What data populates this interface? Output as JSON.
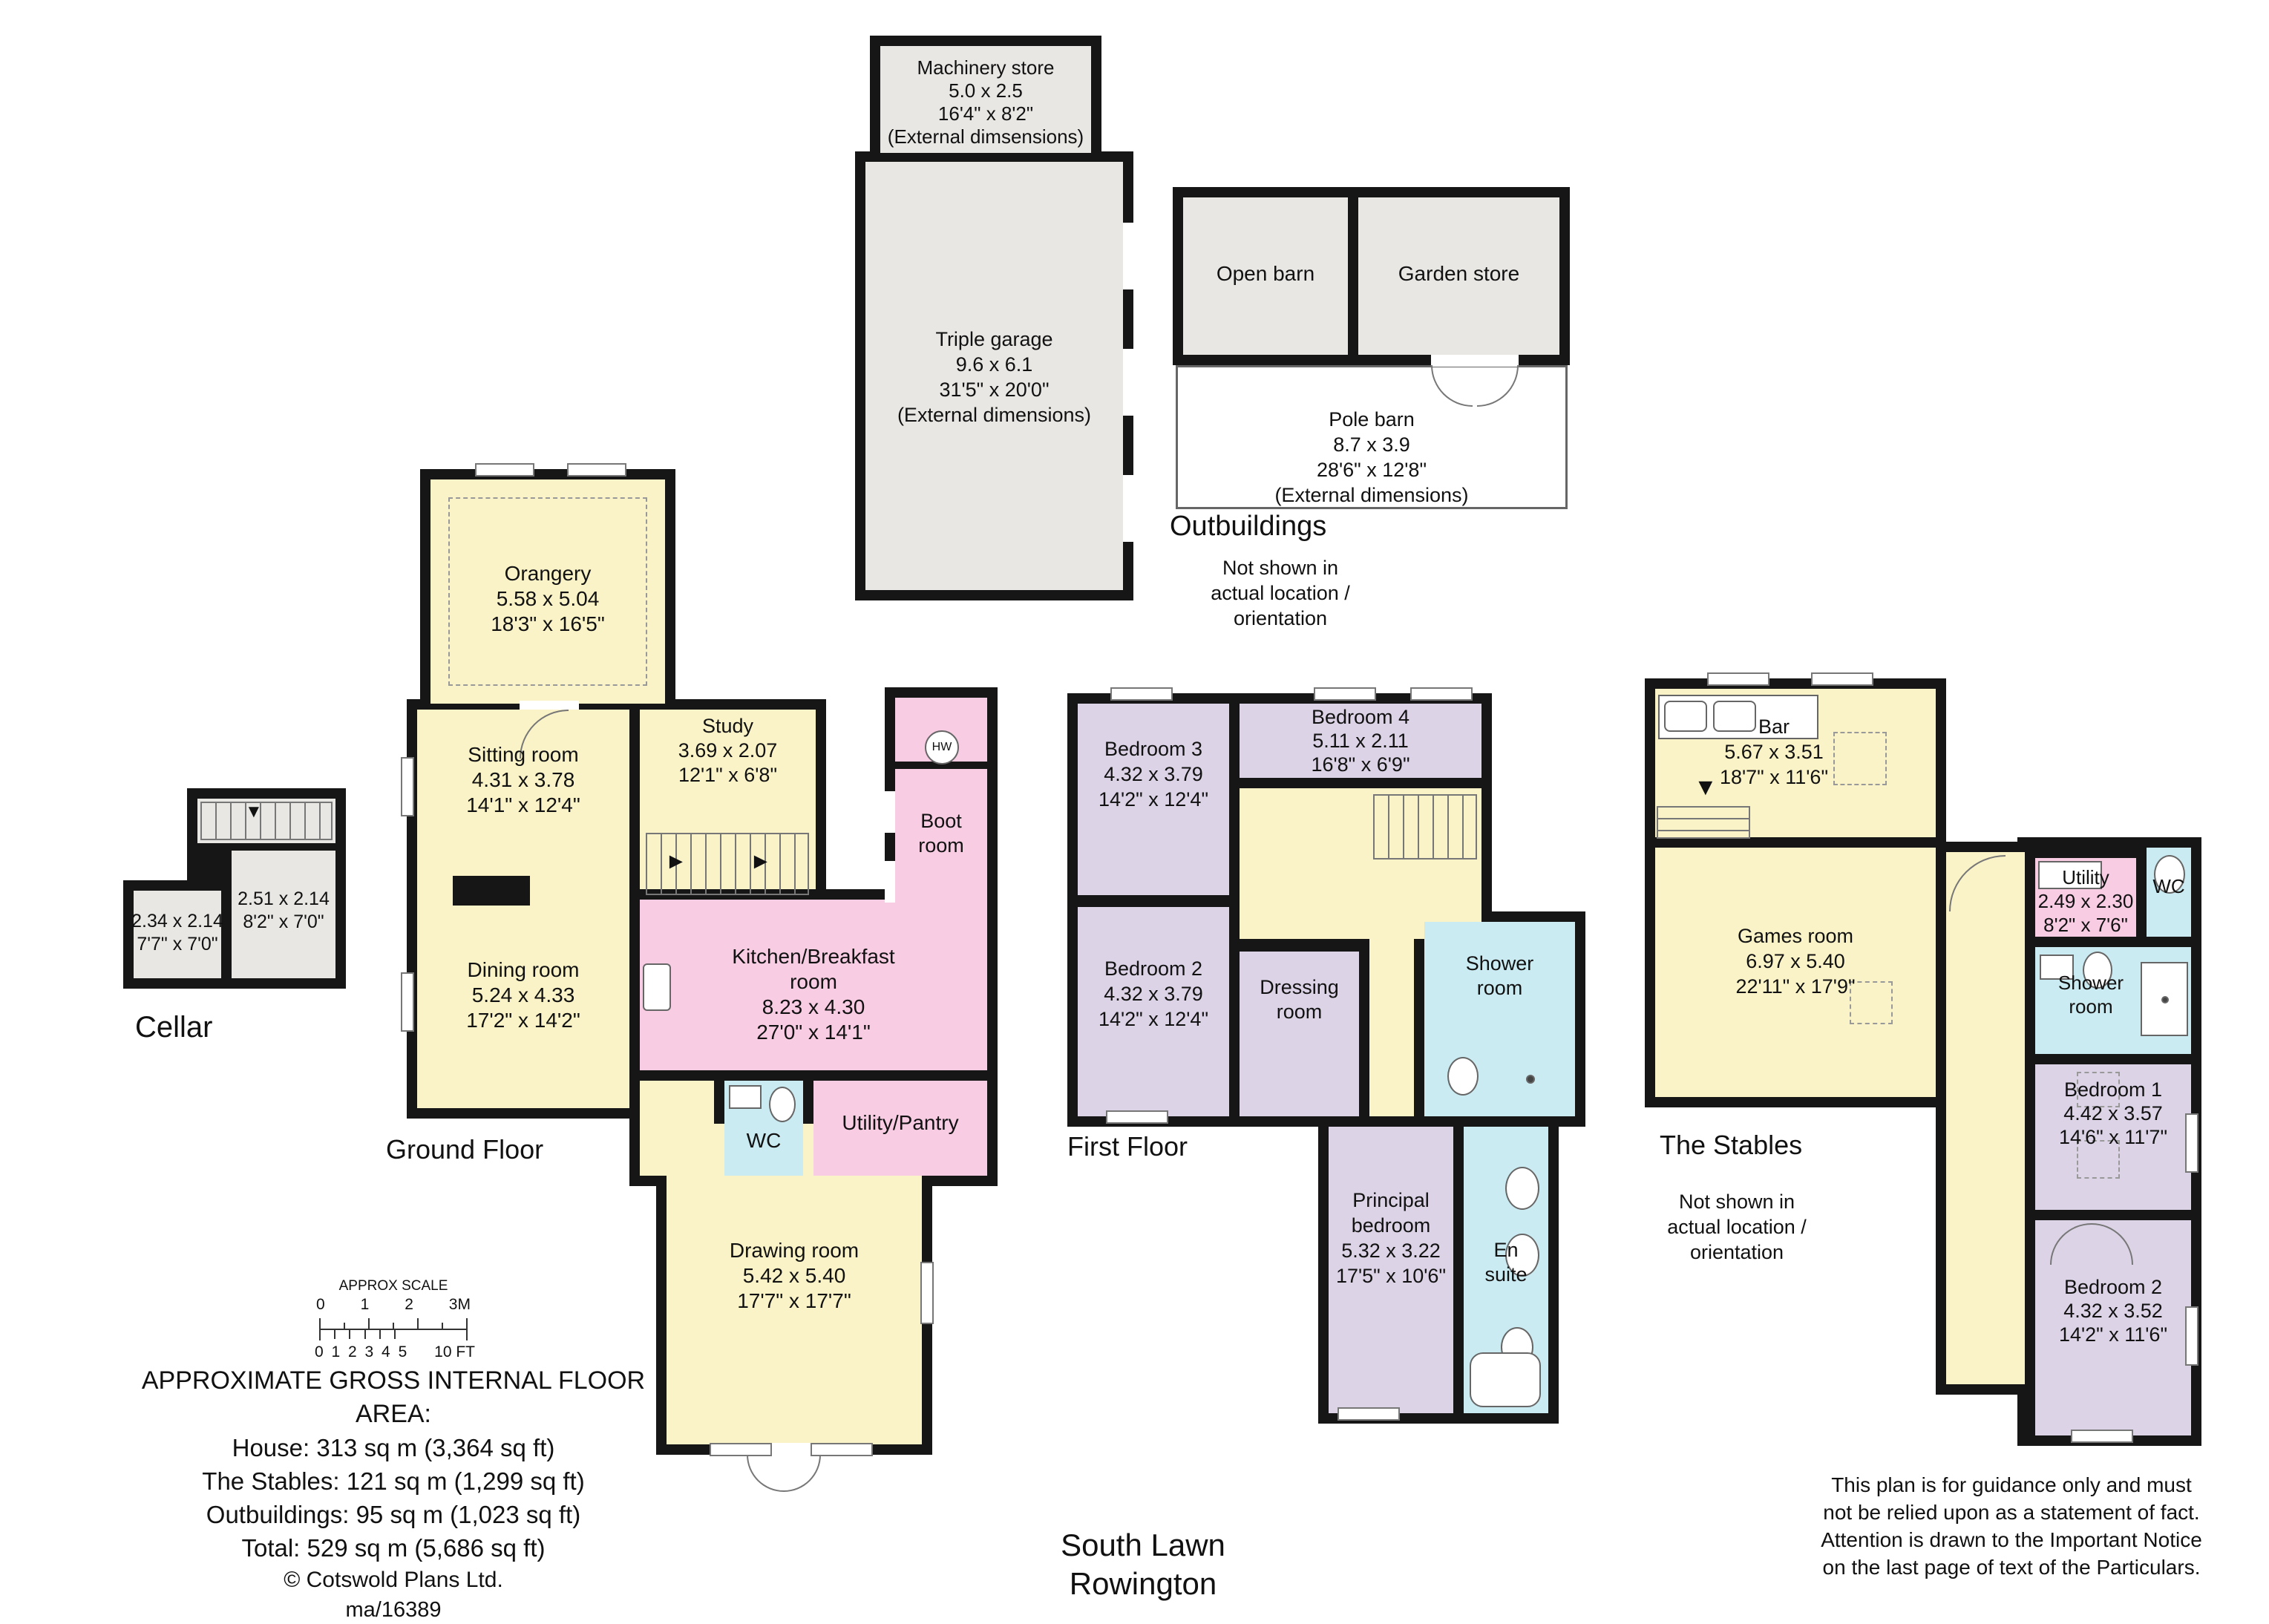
{
  "colors": {
    "wall": "#161616",
    "yellow": "#faf3c8",
    "pink": "#f8cce3",
    "purple": "#dcd3e6",
    "cyan": "#cbebf2",
    "gray": "#e8e7e4"
  },
  "outbuildings": {
    "heading": "Outbuildings",
    "note": "Not shown in\nactual location /\norientation",
    "machinery_store": {
      "name": "Machinery store",
      "m": "5.0 x 2.5",
      "ft": "16'4\" x 8'2\"",
      "note": "(External dimsensions)"
    },
    "triple_garage": {
      "name": "Triple garage",
      "m": "9.6 x 6.1",
      "ft": "31'5\" x 20'0\"",
      "note": "(External dimensions)"
    },
    "open_barn": {
      "name": "Open barn"
    },
    "garden_store": {
      "name": "Garden store"
    },
    "pole_barn": {
      "name": "Pole barn",
      "m": "8.7 x 3.9",
      "ft": "28'6\" x 12'8\"",
      "note": "(External dimensions)"
    }
  },
  "ground_floor": {
    "heading": "Ground Floor",
    "cellar_heading": "Cellar",
    "orangery": {
      "name": "Orangery",
      "m": "5.58 x 5.04",
      "ft": "18'3\" x 16'5\""
    },
    "sitting_room": {
      "name": "Sitting room",
      "m": "4.31 x 3.78",
      "ft": "14'1\" x 12'4\""
    },
    "study": {
      "name": "Study",
      "m": "3.69 x 2.07",
      "ft": "12'1\" x 6'8\""
    },
    "dining_room": {
      "name": "Dining room",
      "m": "5.24 x 4.33",
      "ft": "17'2\" x 14'2\""
    },
    "kitchen": {
      "name": "Kitchen/Breakfast\nroom",
      "m": "8.23 x 4.30",
      "ft": "27'0\" x 14'1\""
    },
    "boot_room": {
      "name": "Boot\nroom"
    },
    "wc": {
      "name": "WC"
    },
    "utility_pantry": {
      "name": "Utility/Pantry"
    },
    "drawing_room": {
      "name": "Drawing room",
      "m": "5.42 x 5.40",
      "ft": "17'7\" x 17'7\""
    },
    "hw": "HW",
    "cellar_left": {
      "m": "2.34 x 2.14",
      "ft": "7'7\" x 7'0\""
    },
    "cellar_right": {
      "m": "2.51 x 2.14",
      "ft": "8'2\" x 7'0\""
    }
  },
  "first_floor": {
    "heading": "First Floor",
    "bedroom_3": {
      "name": "Bedroom 3",
      "m": "4.32 x 3.79",
      "ft": "14'2\" x 12'4\""
    },
    "bedroom_4": {
      "name": "Bedroom 4",
      "m": "5.11 x 2.11",
      "ft": "16'8\" x 6'9\""
    },
    "bedroom_2": {
      "name": "Bedroom 2",
      "m": "4.32 x 3.79",
      "ft": "14'2\" x 12'4\""
    },
    "dressing": {
      "name": "Dressing\nroom"
    },
    "shower": {
      "name": "Shower\nroom"
    },
    "principal": {
      "name": "Principal\nbedroom",
      "m": "5.32 x 3.22",
      "ft": "17'5\" x 10'6\""
    },
    "en_suite": {
      "name": "En\nsuite"
    }
  },
  "stables": {
    "heading": "The Stables",
    "note": "Not shown in\nactual location /\norientation",
    "bar": {
      "name": "Bar",
      "m": "5.67 x 3.51",
      "ft": "18'7\" x 11'6\""
    },
    "games_room": {
      "name": "Games room",
      "m": "6.97 x 5.40",
      "ft": "22'11\" x 17'9\""
    },
    "utility": {
      "name": "Utility",
      "m": "2.49 x 2.30",
      "ft": "8'2\" x 7'6\""
    },
    "wc": {
      "name": "WC"
    },
    "shower": {
      "name": "Shower\nroom"
    },
    "bedroom_1": {
      "name": "Bedroom 1",
      "m": "4.42 x 3.57",
      "ft": "14'6\" x 11'7\""
    },
    "bedroom_2": {
      "name": "Bedroom 2",
      "m": "4.32 x 3.52",
      "ft": "14'2\" x 11'6\""
    }
  },
  "footer": {
    "scale": {
      "title": "APPROX SCALE",
      "m_ticks": [
        "0",
        "1",
        "2",
        "3M"
      ],
      "ft_left": "0 1 2 3 4 5",
      "ft_right": "10 FT"
    },
    "area": {
      "heading": "APPROXIMATE GROSS INTERNAL FLOOR AREA:",
      "lines": [
        "House: 313 sq m (3,364 sq ft)",
        "The Stables: 121 sq m (1,299 sq ft)",
        "Outbuildings: 95 sq m (1,023 sq ft)",
        "Total: 529 sq m (5,686 sq ft)"
      ],
      "copyright": "© Cotswold Plans Ltd.",
      "ref": "ma/16389"
    },
    "title": "South Lawn\nRowington",
    "disclaimer": "This plan is for guidance only and must\nnot be relied upon as a statement of fact.\nAttention is drawn to the Important Notice\non the last page of text of the Particulars."
  }
}
